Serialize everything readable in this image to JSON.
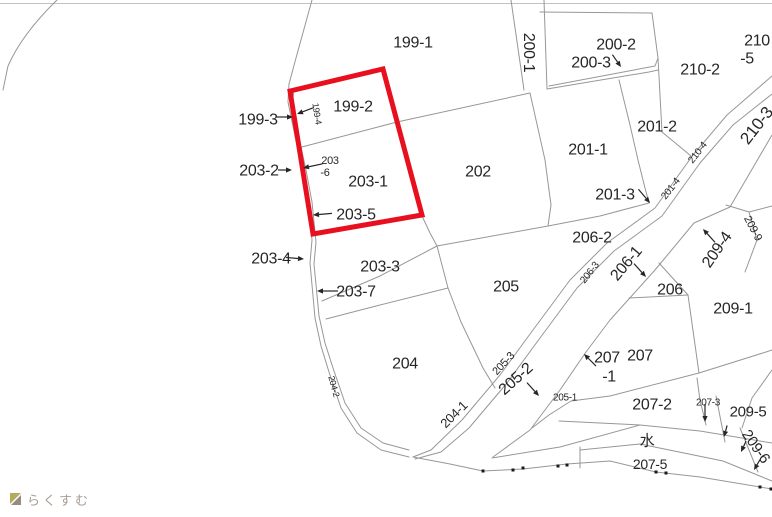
{
  "watermark": {
    "brand": "らくすむ"
  },
  "map": {
    "background_color": "#ffffff",
    "line_color": "#979797",
    "label_color": "#262626",
    "selection": {
      "color": "#e8101e",
      "stroke_width": 5,
      "points": "290,91 383,69 422,215 313,234",
      "parcels_inside": [
        "199-2",
        "203-1",
        "203-5"
      ]
    },
    "labels": [
      {
        "t": "199-1",
        "x": 413,
        "y": 42
      },
      {
        "t": "200-1",
        "x": 524,
        "y": 47,
        "r": 90
      },
      {
        "t": "200-2",
        "x": 616,
        "y": 44
      },
      {
        "t": "200-3",
        "x": 591,
        "y": 62
      },
      {
        "t": "210",
        "x": 757,
        "y": 40
      },
      {
        "t": "-5",
        "x": 747,
        "y": 58
      },
      {
        "t": "210-2",
        "x": 700,
        "y": 69
      },
      {
        "t": "199-3",
        "x": 258,
        "y": 119
      },
      {
        "t": "199-2",
        "x": 353,
        "y": 106
      },
      {
        "t": "199-4",
        "x": 314,
        "y": 111,
        "r": 81,
        "s": 9
      },
      {
        "t": "203-2",
        "x": 259,
        "y": 170
      },
      {
        "t": "203",
        "x": 330,
        "y": 160,
        "s": 11
      },
      {
        "t": "-6",
        "x": 325,
        "y": 172,
        "s": 11
      },
      {
        "t": "203-1",
        "x": 368,
        "y": 181
      },
      {
        "t": "202",
        "x": 478,
        "y": 171
      },
      {
        "t": "201-1",
        "x": 588,
        "y": 149
      },
      {
        "t": "201-2",
        "x": 657,
        "y": 126
      },
      {
        "t": "201-3",
        "x": 615,
        "y": 194
      },
      {
        "t": "201-4",
        "x": 673,
        "y": 187,
        "r": -52,
        "s": 10
      },
      {
        "t": "210-4",
        "x": 700,
        "y": 151,
        "r": -52,
        "s": 10
      },
      {
        "t": "210-3",
        "x": 761,
        "y": 123,
        "r": -52,
        "s": 17
      },
      {
        "t": "203-5",
        "x": 356,
        "y": 214
      },
      {
        "t": "203-4",
        "x": 271,
        "y": 258
      },
      {
        "t": "203-3",
        "x": 380,
        "y": 266
      },
      {
        "t": "203-7",
        "x": 356,
        "y": 291
      },
      {
        "t": "206-2",
        "x": 592,
        "y": 237
      },
      {
        "t": "206-3",
        "x": 592,
        "y": 271,
        "r": -52,
        "s": 10
      },
      {
        "t": "206-1",
        "x": 630,
        "y": 261,
        "r": -50
      },
      {
        "t": "206",
        "x": 670,
        "y": 289
      },
      {
        "t": "209-4",
        "x": 721,
        "y": 247,
        "r": -55
      },
      {
        "t": "209-9",
        "x": 750,
        "y": 226,
        "r": 62,
        "s": 11
      },
      {
        "t": "209-1",
        "x": 733,
        "y": 308
      },
      {
        "t": "205",
        "x": 506,
        "y": 286
      },
      {
        "t": "204",
        "x": 405,
        "y": 363
      },
      {
        "t": "205-3",
        "x": 506,
        "y": 362,
        "r": -47,
        "s": 11
      },
      {
        "t": "205-2",
        "x": 519,
        "y": 377,
        "r": -42
      },
      {
        "t": "204-1",
        "x": 457,
        "y": 413,
        "r": -45,
        "s": 13
      },
      {
        "t": "204-2",
        "x": 331,
        "y": 384,
        "r": 75,
        "s": 9
      },
      {
        "t": "205-1",
        "x": 565,
        "y": 397,
        "s": 10
      },
      {
        "t": "207",
        "x": 640,
        "y": 355
      },
      {
        "t": "207",
        "x": 607,
        "y": 357
      },
      {
        "t": "-1",
        "x": 609,
        "y": 376
      },
      {
        "t": "207-2",
        "x": 652,
        "y": 404
      },
      {
        "t": "207-3",
        "x": 708,
        "y": 402,
        "s": 10
      },
      {
        "t": "209-5",
        "x": 748,
        "y": 411,
        "s": 15
      },
      {
        "t": "209-6",
        "x": 752,
        "y": 444,
        "r": 55,
        "s": 15
      },
      {
        "t": "水",
        "x": 647,
        "y": 440,
        "s": 15
      },
      {
        "t": "207-5",
        "x": 650,
        "y": 464,
        "s": 14
      }
    ],
    "arrows": [
      {
        "x": 293,
        "y": 117,
        "a": 0,
        "l": 10
      },
      {
        "x": 297,
        "y": 114,
        "a": 159,
        "l": 12
      },
      {
        "x": 292,
        "y": 170,
        "a": 0,
        "l": 8
      },
      {
        "x": 303,
        "y": 168,
        "a": 168,
        "l": 14
      },
      {
        "x": 313,
        "y": 215,
        "a": 175,
        "l": 13
      },
      {
        "x": 304,
        "y": 259,
        "a": 5,
        "l": 12
      },
      {
        "x": 317,
        "y": 291,
        "a": 180,
        "l": 15
      },
      {
        "x": 621,
        "y": 67,
        "a": 55,
        "l": 9
      },
      {
        "x": 650,
        "y": 203,
        "a": 50,
        "l": 12
      },
      {
        "x": 646,
        "y": 277,
        "a": 48,
        "l": 12
      },
      {
        "x": 703,
        "y": 229,
        "a": 228,
        "l": 12
      },
      {
        "x": 539,
        "y": 396,
        "a": 48,
        "l": 12
      },
      {
        "x": 584,
        "y": 354,
        "a": 225,
        "l": 11
      },
      {
        "x": 705,
        "y": 422,
        "a": 90,
        "l": 12
      },
      {
        "x": 724,
        "y": 437,
        "a": 105,
        "l": 6
      },
      {
        "x": 741,
        "y": 452,
        "a": 115,
        "l": 6
      },
      {
        "x": 754,
        "y": 470,
        "a": 120,
        "l": 6
      }
    ],
    "survey_dots": [
      [
        483,
        471
      ],
      [
        513,
        470
      ],
      [
        523,
        468
      ],
      [
        558,
        466
      ],
      [
        567,
        465
      ],
      [
        656,
        472
      ],
      [
        666,
        473
      ],
      [
        760,
        487
      ],
      [
        771,
        489
      ]
    ],
    "logo_colors": {
      "roof": "#b3ab5e",
      "base": "#968b80"
    }
  }
}
